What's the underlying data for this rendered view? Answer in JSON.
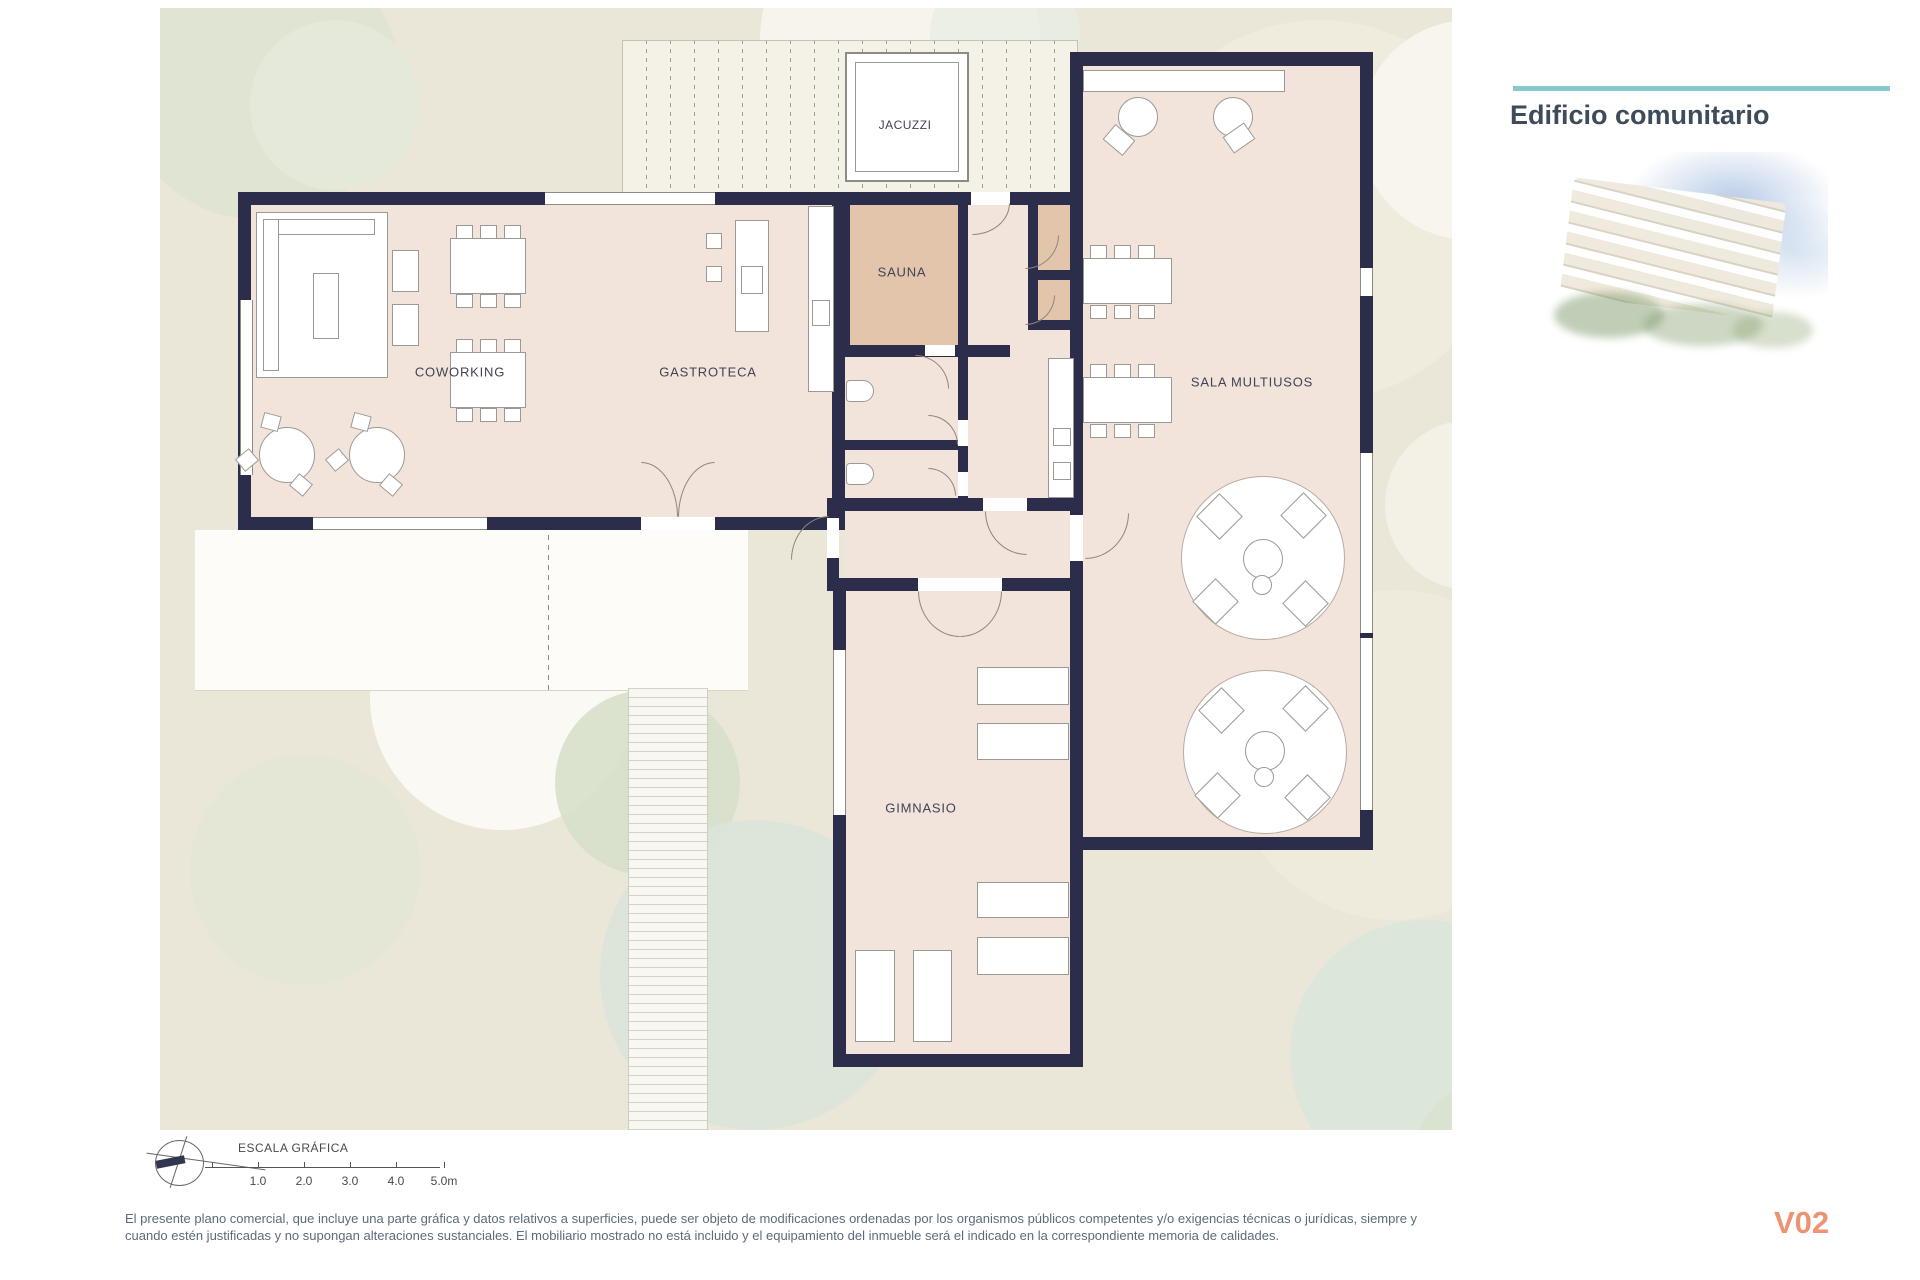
{
  "header": {
    "title": "Edificio comunitario"
  },
  "plan": {
    "rooms": {
      "jacuzzi": "JACUZZI",
      "sauna": "SAUNA",
      "coworking": "COWORKING",
      "gastroteca": "GASTROTECA",
      "sala_multiusos": "SALA MULTIUSOS",
      "gimnasio": "GIMNASIO"
    }
  },
  "scale_bar": {
    "title": "ESCALA GRÁFICA",
    "ticks": [
      "1.0",
      "2.0",
      "3.0",
      "4.0",
      "5.0m"
    ]
  },
  "disclaimer": {
    "line1": "El presente plano comercial, que incluye una parte gráfica y datos relativos a superficies, puede ser objeto de modificaciones ordenadas por los organismos públicos competentes y/o exigencias técnicas o jurídicas, siempre y",
    "line2": "cuando estén justificadas y no supongan alteraciones sustanciales. El mobiliario mostrado no está incluido y el equipamiento del inmueble será el indicado en la correspondiente memoria de calidades."
  },
  "version_label": "V02",
  "colors": {
    "accent_teal": "#85C8CD",
    "wall_navy": "#2B2D4B",
    "room_pink": "#F2E3DB",
    "sauna_tan": "#E3C5AB",
    "version_salmon": "#EC9372"
  }
}
